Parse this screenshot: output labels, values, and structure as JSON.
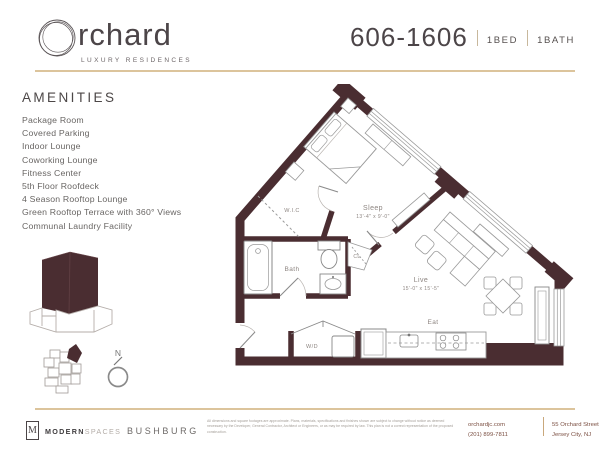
{
  "header": {
    "logo": {
      "o": "O",
      "wordmark": "rchard",
      "tagline": "LUXURY RESIDENCES"
    },
    "unit_number": "606-1606",
    "bed_label": "1BED",
    "bath_label": "1BATH"
  },
  "amenities": {
    "title": "AMENITIES",
    "items": [
      "Package Room",
      "Covered Parking",
      "Indoor Lounge",
      "Coworking Lounge",
      "Fitness Center",
      "5th Floor Roofdeck",
      "4 Season Rooftop Lounge",
      "Green Rooftop Terrace with 360° Views",
      "Communal Laundry Facility"
    ]
  },
  "floor_plan": {
    "sleep_name": "Sleep",
    "sleep_dims": "13'-4\" x 9'-0\"",
    "live_name": "Live",
    "live_dims": "15'-0\" x 15'-5\"",
    "eat": "Eat",
    "bath": "Bath",
    "wic": "W.I.C",
    "cl": "CL",
    "wd": "W/D"
  },
  "locator": {
    "compass": "N"
  },
  "footer": {
    "modernspaces": {
      "initial": "M",
      "bold": "MODERN",
      "light": "SPACES"
    },
    "bushburg": "BUSHBURG",
    "disclaimer": "All dimensions and square footages are approximate. Plans, materials, specifications and finishes shown are subject to change without notice as deemed necessary by the Developer, General Contractor, Architect or Engineers, or as may be required by law. This plan is not a correct representation of the proposed construction.",
    "website": "orchardjc.com",
    "phone": "(201) 899-7811",
    "address_line1": "55 Orchard Street",
    "address_line2": "Jersey City, NJ"
  },
  "colors": {
    "wall": "#4a2d31",
    "accent_line": "#dcc49c"
  }
}
